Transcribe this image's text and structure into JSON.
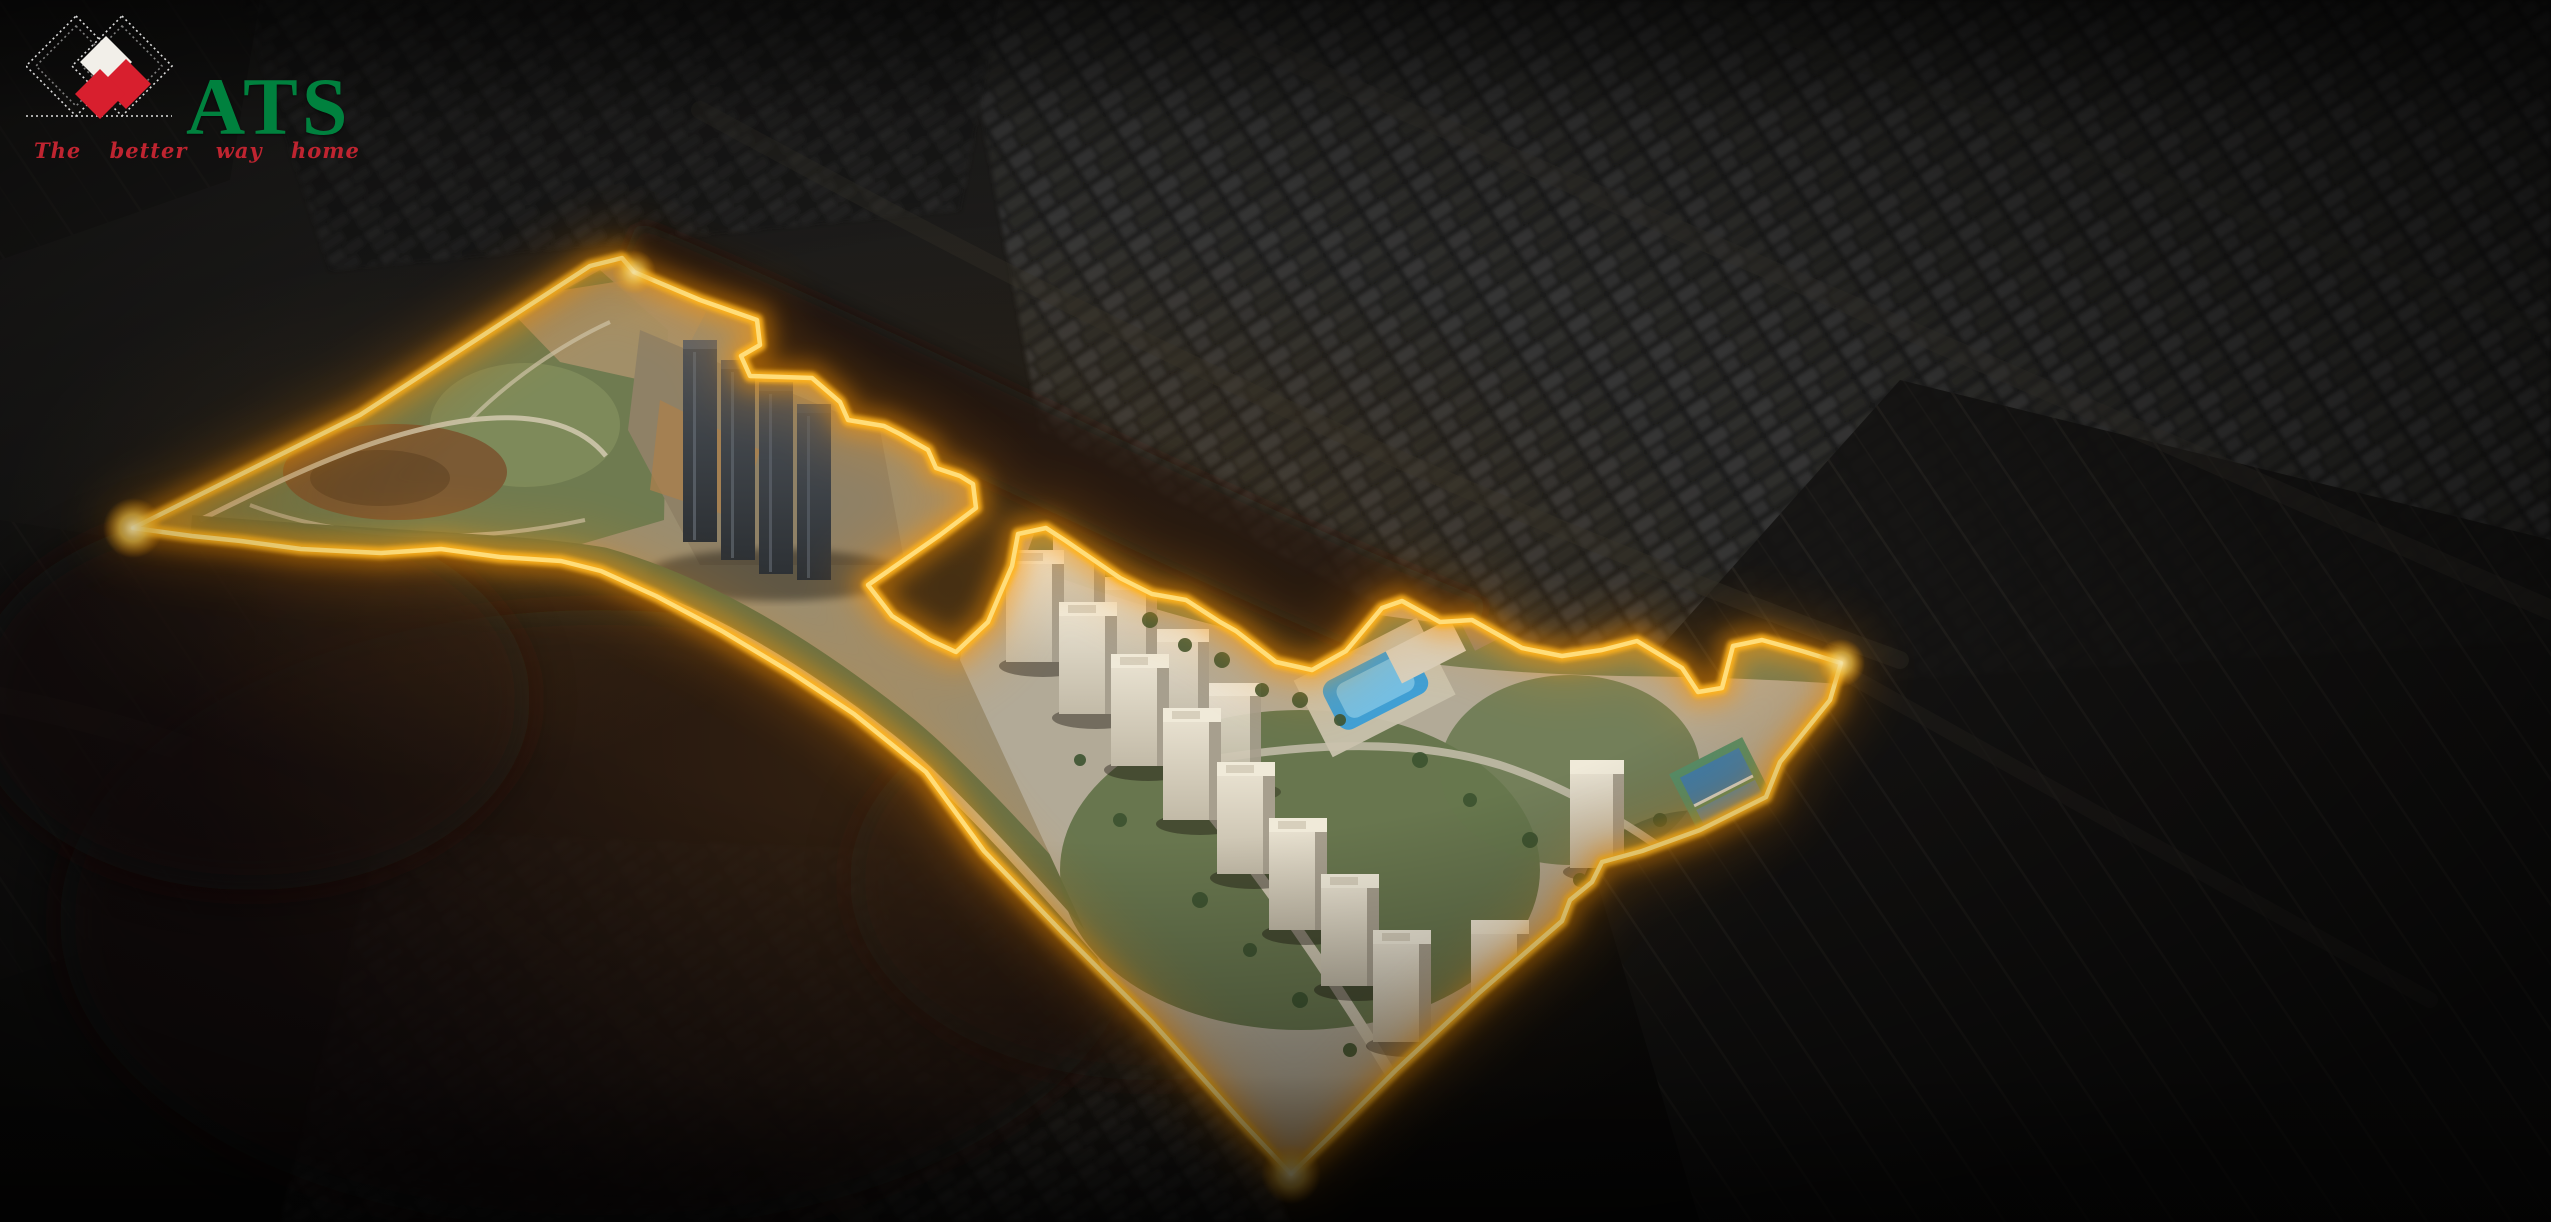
{
  "logo": {
    "brand": "ATS",
    "tagline": "The better way home"
  },
  "colors": {
    "brand_green": "#00813e",
    "brand_red": "#d81f2e",
    "tagline_red": "#bf2430",
    "boundary_gold": "#ffb41e",
    "boundary_glow": "#ff9500",
    "background_dark": "#121110"
  }
}
